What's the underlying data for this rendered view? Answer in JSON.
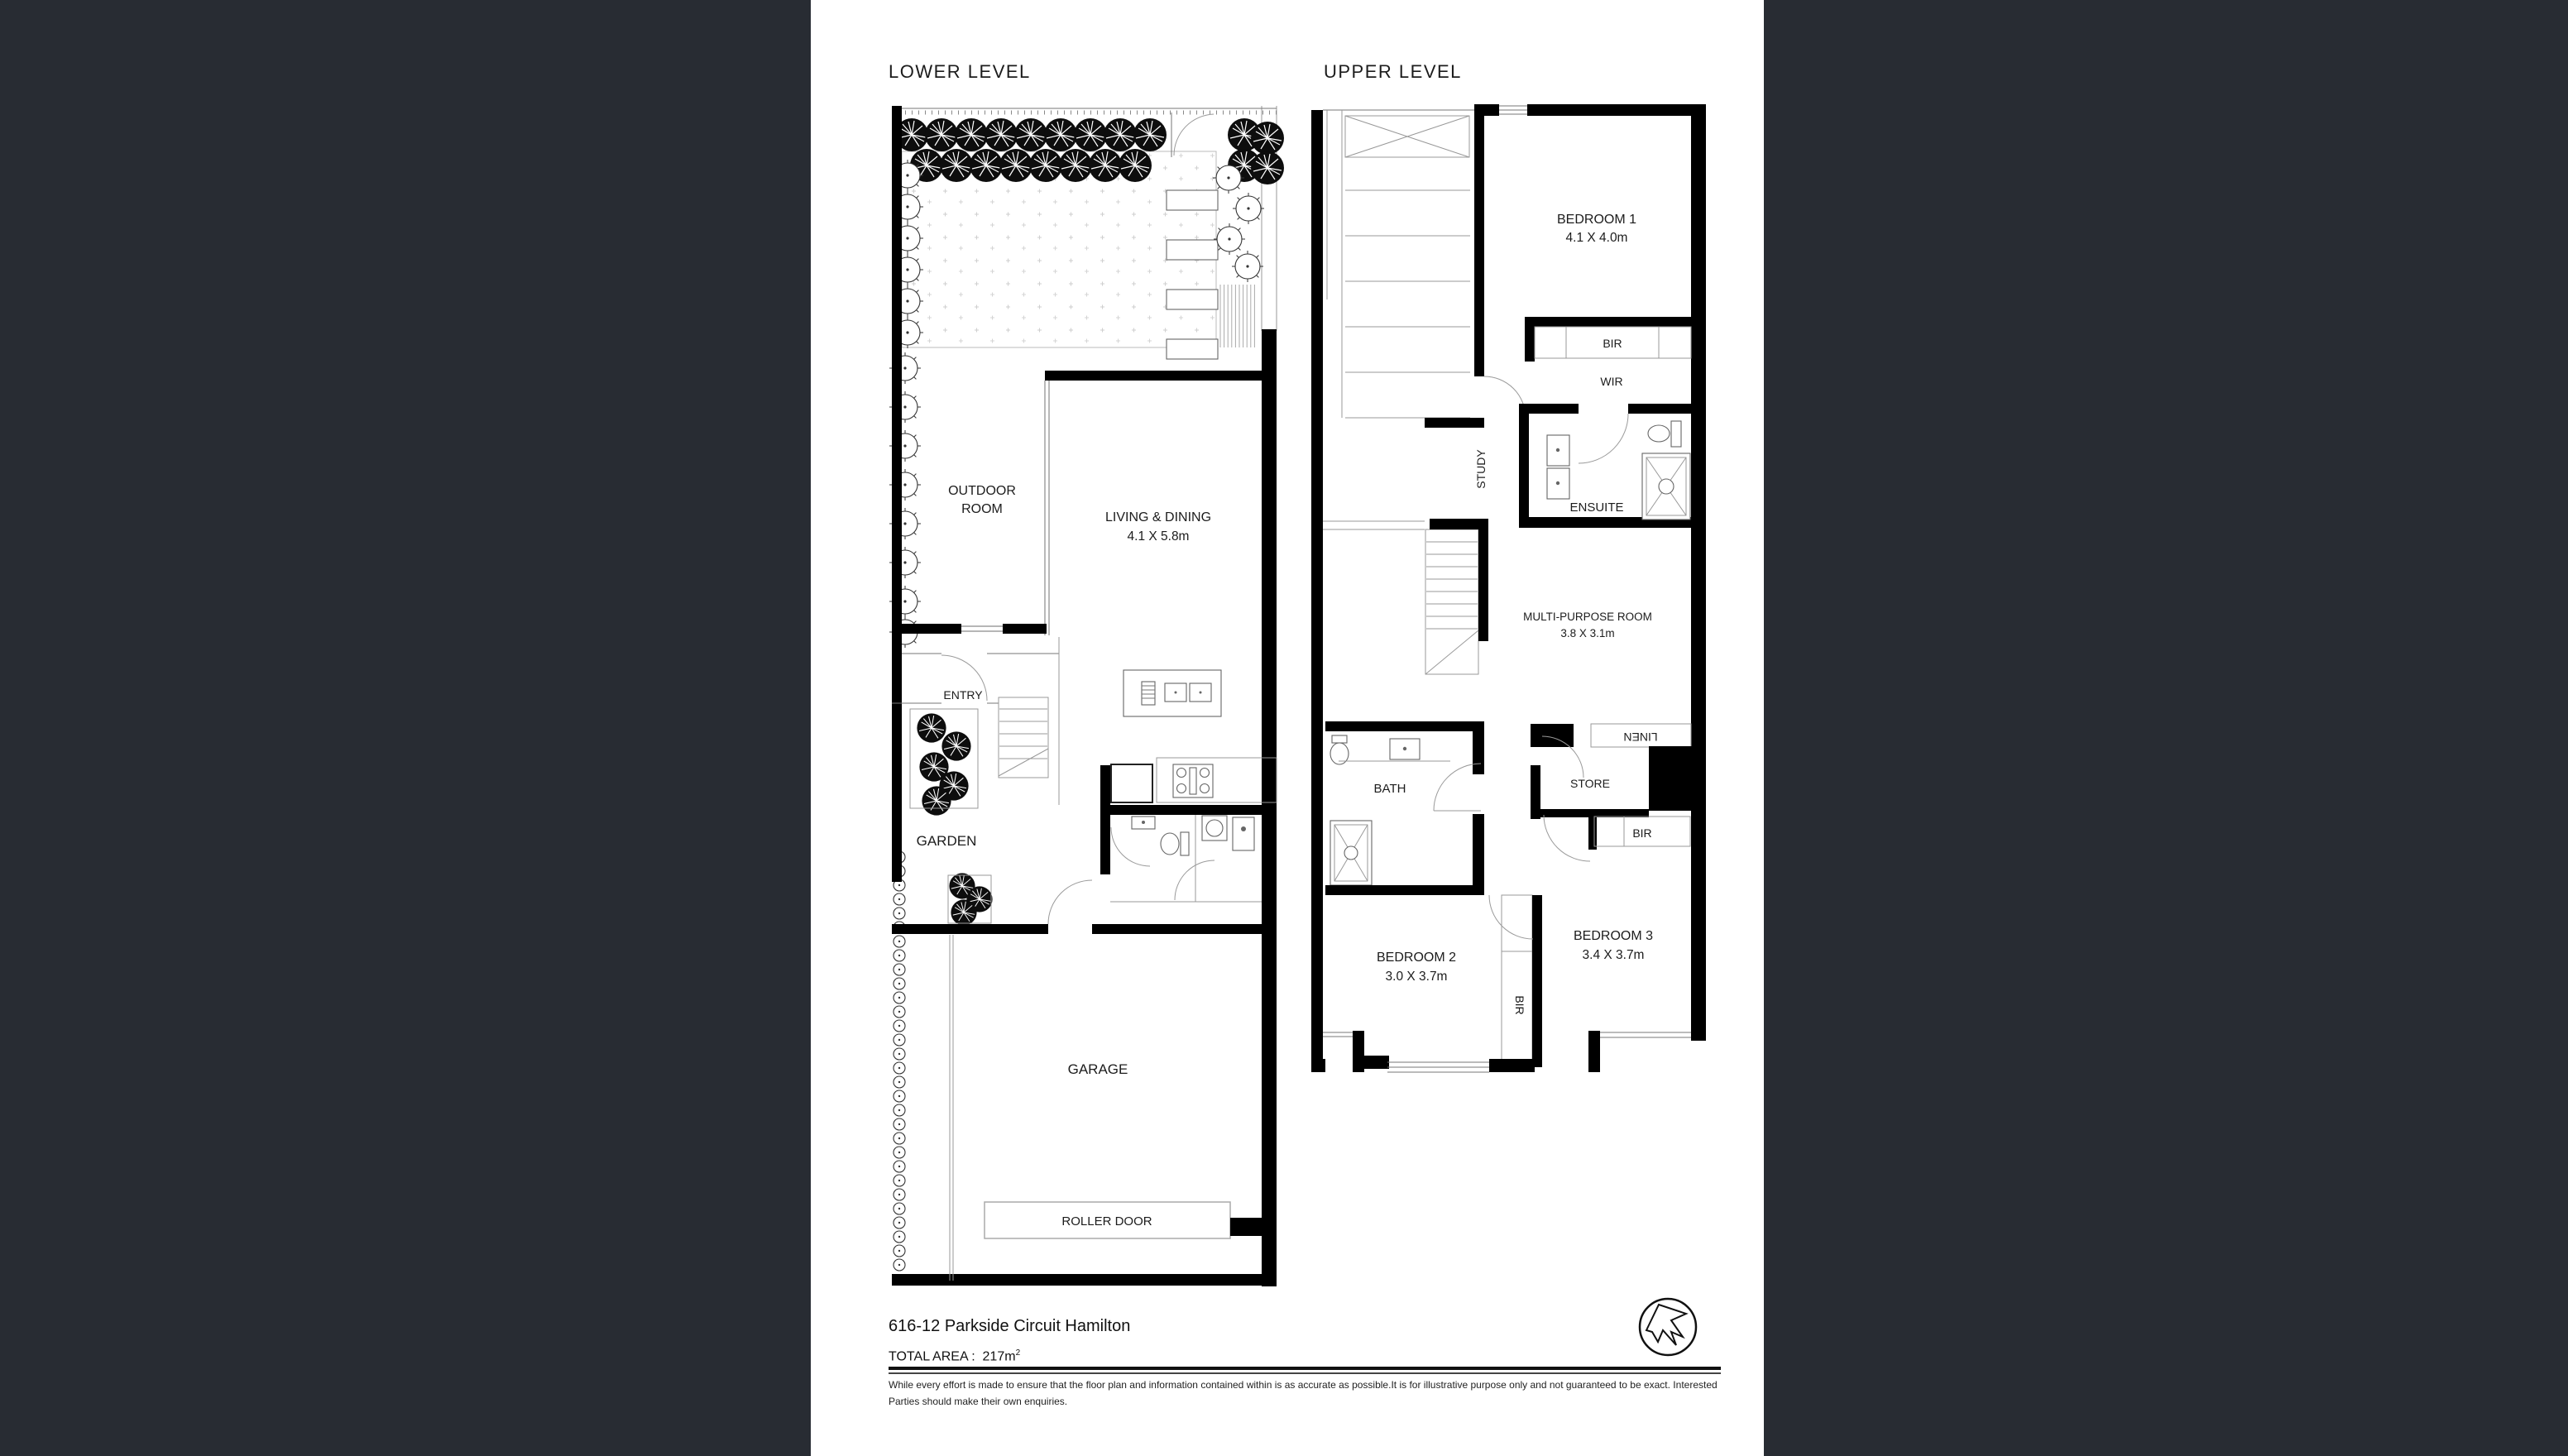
{
  "page": {
    "background": "#282c33",
    "paper": "#ffffff"
  },
  "lower_level": {
    "title": "LOWER LEVEL",
    "outdoor_room_line1": "OUTDOOR",
    "outdoor_room_line2": "ROOM",
    "living_dining": "LIVING & DINING",
    "living_dining_dims": "4.1 X 5.8m",
    "entry": "ENTRY",
    "garden": "GARDEN",
    "garage": "GARAGE",
    "roller_door": "ROLLER DOOR"
  },
  "upper_level": {
    "title": "UPPER LEVEL",
    "bedroom1": "BEDROOM 1",
    "bedroom1_dims": "4.1 X 4.0m",
    "bir_bedroom1": "BIR",
    "wir": "WIR",
    "study": "STUDY",
    "ensuite": "ENSUITE",
    "multi_purpose": "MULTI-PURPOSE ROOM",
    "multi_purpose_dims": "3.8 X 3.1m",
    "linen": "LINEN",
    "store": "STORE",
    "bath": "BATH",
    "bir_bedroom3": "BIR",
    "bir_bedroom2": "BIR",
    "bedroom2": "BEDROOM 2",
    "bedroom2_dims": "3.0 X 3.7m",
    "bedroom3": "BEDROOM 3",
    "bedroom3_dims": "3.4 X 3.7m"
  },
  "footer": {
    "address": "616-12 Parkside Circuit Hamilton",
    "total_area_label": "TOTAL AREA :",
    "total_area_value": "217m",
    "total_area_sup": "2",
    "disclaimer_line1": "While every effort is made to ensure that the floor plan and information contained within is as  accurate as possible.It is for illustrative purpose only and not guaranteed to be exact. Interested",
    "disclaimer_line2": "Parties should make their own enquiries."
  }
}
